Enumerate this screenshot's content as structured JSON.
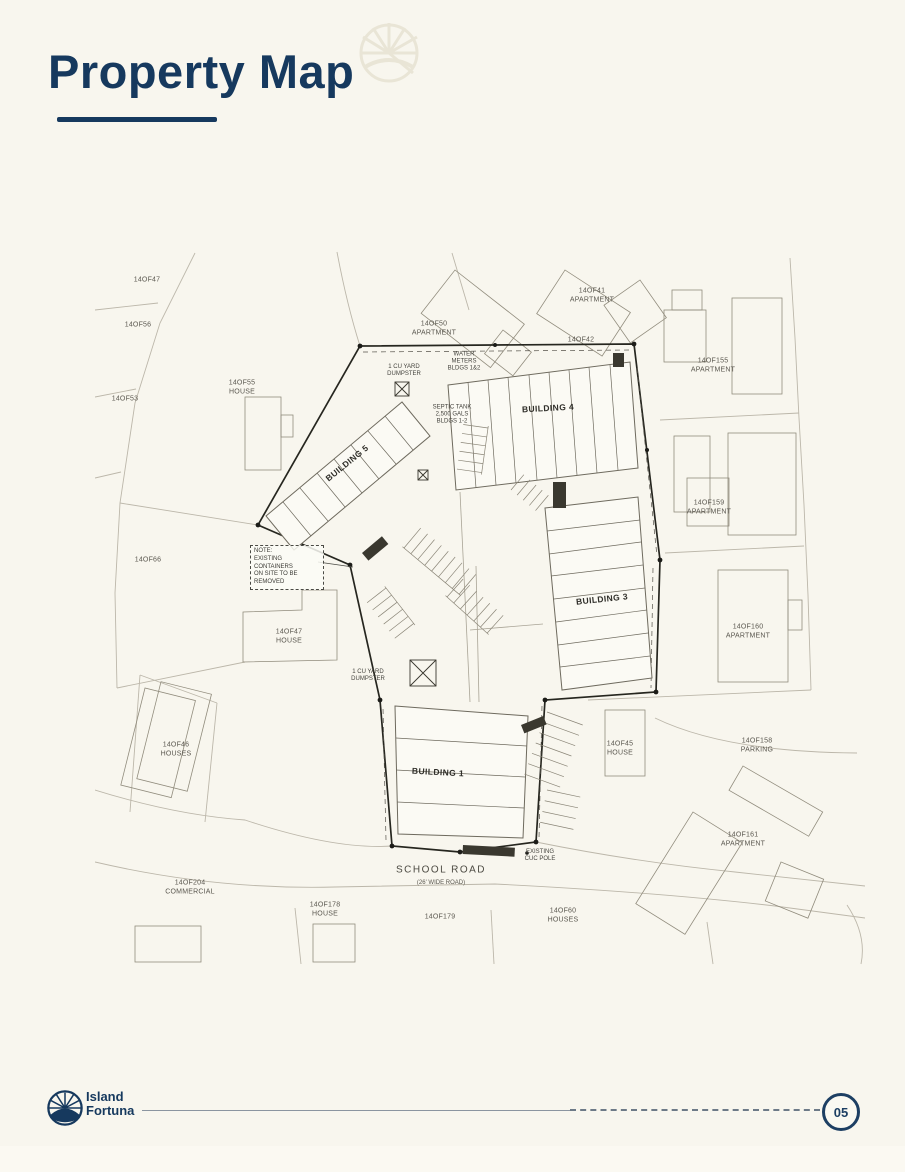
{
  "page": {
    "title": "Property Map",
    "page_number": "05"
  },
  "brand": {
    "name": "Island\nFortuna"
  },
  "map": {
    "road": {
      "name": "SCHOOL ROAD",
      "sub": "(26' WIDE ROAD)"
    },
    "buildings": [
      {
        "label": "BUILDING 5"
      },
      {
        "label": "BUILDING 4"
      },
      {
        "label": "BUILDING 3"
      },
      {
        "label": "BUILDING 1"
      }
    ],
    "parcels": [
      {
        "label": "14OF47"
      },
      {
        "label": "14OF56"
      },
      {
        "label": "14OF53"
      },
      {
        "label": "14OF55\nHOUSE"
      },
      {
        "label": "14OF66"
      },
      {
        "label": "14OF47\nHOUSE"
      },
      {
        "label": "14OF46\nHOUSES"
      },
      {
        "label": "14OF204\nCOMMERCIAL"
      },
      {
        "label": "14OF178\nHOUSE"
      },
      {
        "label": "14OF179"
      },
      {
        "label": "14OF60\nHOUSES"
      },
      {
        "label": "14OF42"
      },
      {
        "label": "14OF41\nAPARTMENT"
      },
      {
        "label": "14OF50\nAPARTMENT"
      },
      {
        "label": "14OF155\nAPARTMENT"
      },
      {
        "label": "14OF159\nAPARTMENT"
      },
      {
        "label": "14OF160\nAPARTMENT"
      },
      {
        "label": "14OF45\nHOUSE"
      },
      {
        "label": "14OF158\nPARKING"
      },
      {
        "label": "14OF161\nAPARTMENT"
      }
    ],
    "annotations": {
      "note": "NOTE:\nEXISTING CONTAINERS\nON SITE TO BE REMOVED",
      "water_meters": "WATER\nMETERS\nBLDGS 1&2",
      "septic": "SEPTIC TANK\n2,500 GALS\nBLDGS 1-2",
      "dumpster_top": "1 CU YARD\nDUMPSTER",
      "dumpster_mid": "1 CU YARD\nDUMPSTER",
      "cuc_pole": "EXISTING\nCUC POLE"
    }
  },
  "colors": {
    "navy": "#16395e",
    "cream": "#f8f6ee",
    "ink": "#26261f"
  }
}
